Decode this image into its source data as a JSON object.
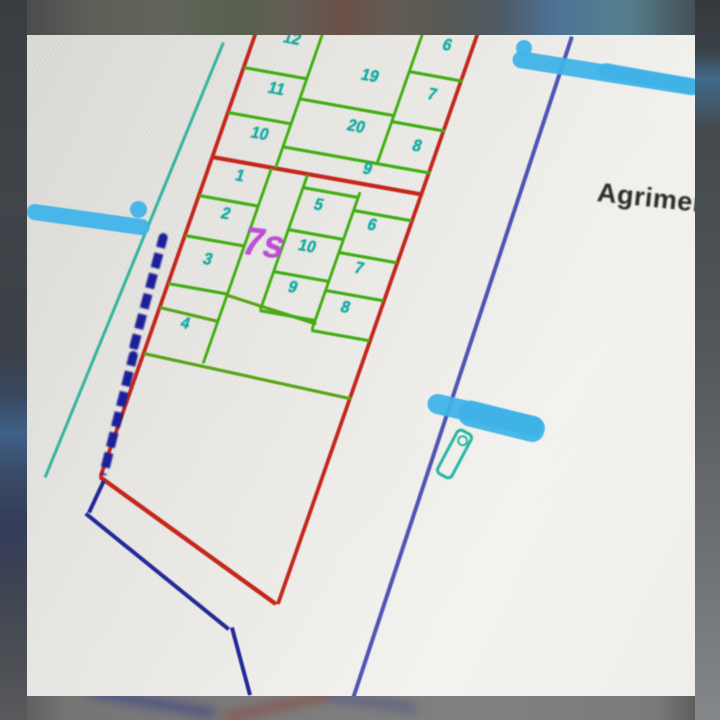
{
  "photo": {
    "description": "hand-annotated photo of a cadastral subdivision plan on paper",
    "colors": {
      "paper": "#ebeae6",
      "boundary_red": "#c4271b",
      "parcel_green": "#3fae12",
      "number_teal": "#10aaa2",
      "road_teal": "#35b4a0",
      "ink_navy": "#1c1f99",
      "line_blue_violet": "#4f55b5",
      "highlighter_blue": "#3fb3e8",
      "plot_label_purple": "#bb4fd4",
      "text_black": "#2a2a2a"
    },
    "plan": {
      "parcels": {
        "u12": "12",
        "u11": "11",
        "u10": "10",
        "u19": "19",
        "u20": "20",
        "u6": "6",
        "u7": "7",
        "u8": "8",
        "u9": "9",
        "l1": "1",
        "l2": "2",
        "l3": "3",
        "l4": "4",
        "c5": "5",
        "c6": "6",
        "c10": "10",
        "c7": "7",
        "c9": "9",
        "c8": "8"
      },
      "upper_block_left_column": [
        "12",
        "11",
        "10"
      ],
      "upper_block_middle_column": [
        "19",
        "20"
      ],
      "upper_block_right_column": [
        "6",
        "7",
        "8"
      ],
      "upper_block_wide_parcel": "9",
      "lower_block_left_column": [
        "1",
        "2",
        "3",
        "4"
      ],
      "center_block_rows": [
        [
          "5",
          "6"
        ],
        [
          "10",
          "7"
        ],
        [
          "9",
          "8"
        ]
      ]
    },
    "annotations": {
      "plot_label": "7s",
      "surveyor_text": "Agrimen",
      "highlighter_marks_count": "3"
    }
  }
}
